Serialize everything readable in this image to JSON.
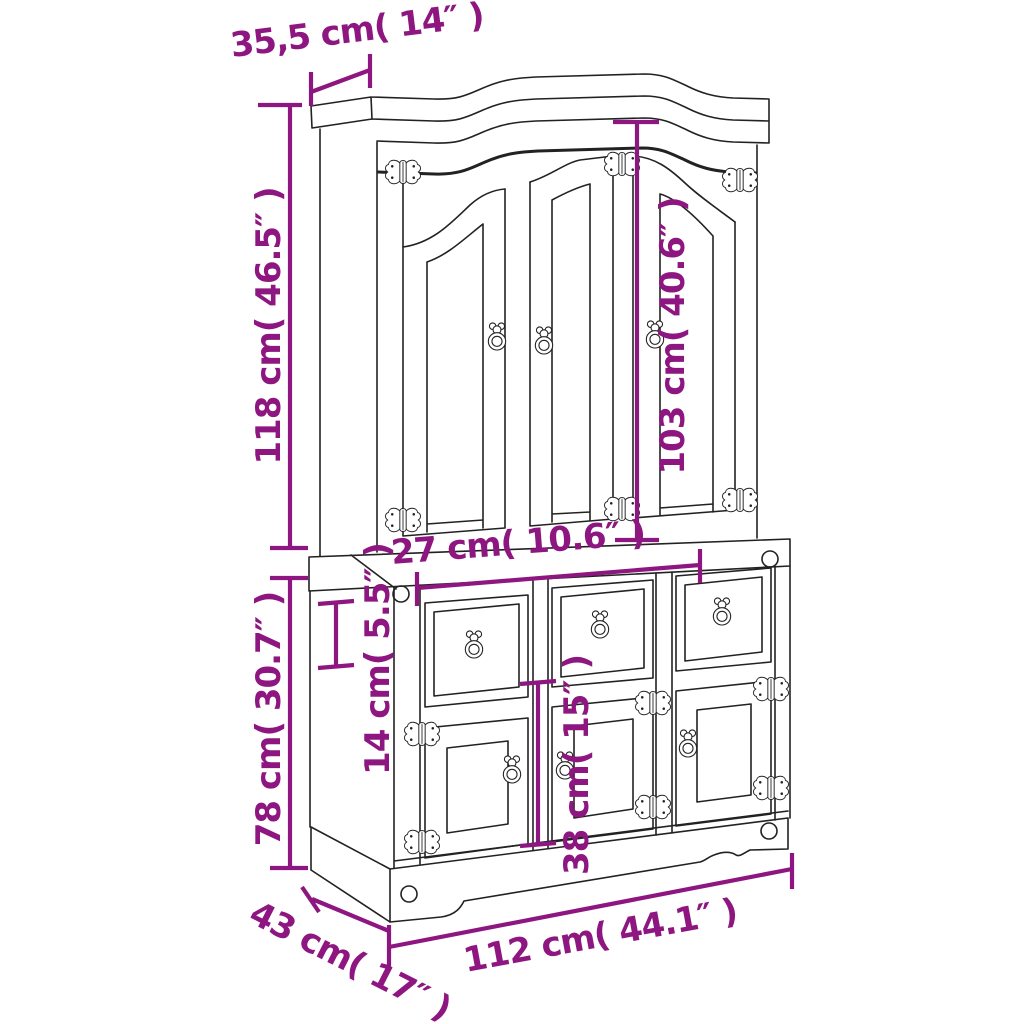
{
  "figure": {
    "title": "Corona hutch cabinet dimension diagram",
    "background_color": "#ffffff",
    "line_color": "#222222",
    "dimension_color": "#8E1680"
  },
  "dimensions": {
    "top_depth": "35,5 cm( 14″ )",
    "upper_height": "118 cm( 46.5″ )",
    "upper_door_height": "103 cm( 40.6″ )",
    "drawer_width": "27 cm( 10.6″ )",
    "drawer_height": "14 cm( 5.5″ )",
    "lower_height": "78 cm( 30.7″ )",
    "lower_door_height": "38 cm( 15″ )",
    "depth": "43 cm( 17″ )",
    "width": "112 cm( 44.1″ )"
  }
}
